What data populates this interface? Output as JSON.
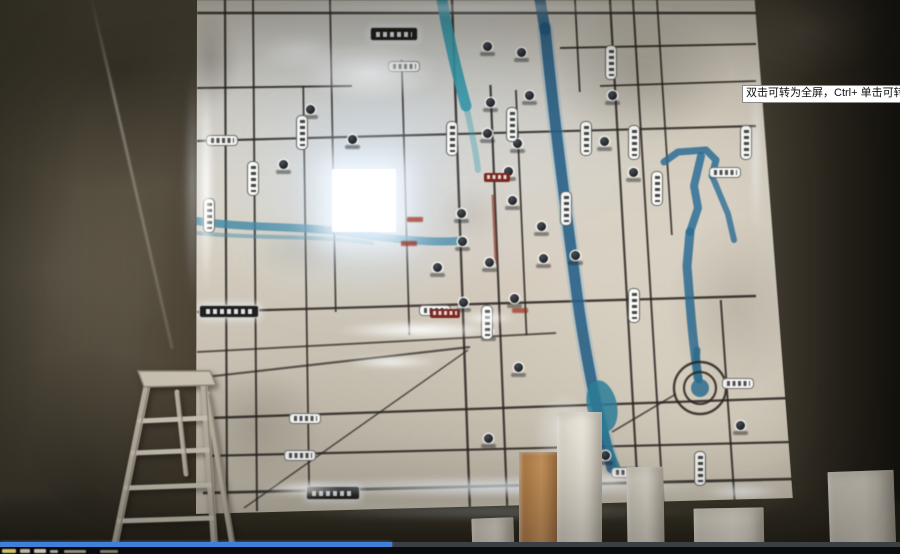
{
  "window": {
    "width": 900,
    "height": 554
  },
  "video_player": {
    "tooltip_text": "双击可转为全屏，Ctrl+ 单击可转为",
    "progress_fraction": 0.436,
    "progress_color": "#3f80d8",
    "track_color": "#3b3e44",
    "control_bar_color": "#0a0b0c",
    "control_fragments": [
      [
        2,
        549,
        14,
        4,
        "#cdbf6e"
      ],
      [
        20,
        549,
        10,
        4,
        "#b9b39e"
      ],
      [
        34,
        549,
        12,
        4,
        "#c5c0ae"
      ],
      [
        50,
        550,
        8,
        3,
        "#a8a392"
      ],
      [
        64,
        550,
        22,
        3,
        "#8f8a7a"
      ],
      [
        100,
        550,
        18,
        3,
        "#7d7868"
      ]
    ]
  },
  "palette": {
    "road": "#2b2823",
    "map_base": "#d3ccbe",
    "glow": "#eef6ff",
    "water_teal": "#3e88a8",
    "water_dark": "#255e86",
    "wall": "#4a4437",
    "ladder_metal": "#b5ad9e",
    "ladder_stroke": "#8c8679"
  },
  "map": {
    "h_roads": [
      [
        197,
        13,
        756,
        13,
        2.4
      ],
      [
        197,
        88,
        352,
        86,
        2.0
      ],
      [
        197,
        141,
        756,
        126,
        2.2
      ],
      [
        560,
        48,
        756,
        44,
        2.0
      ],
      [
        600,
        86,
        756,
        81,
        1.8
      ],
      [
        197,
        312,
        756,
        296,
        2.4
      ],
      [
        210,
        418,
        792,
        398,
        2.4
      ],
      [
        205,
        456,
        792,
        442,
        2.2
      ],
      [
        203,
        493,
        793,
        479,
        2.8
      ]
    ],
    "v_roads": [
      [
        225,
        0,
        511,
        2.2
      ],
      [
        253,
        0,
        511,
        2.0
      ],
      [
        302,
        86,
        493,
        1.8
      ],
      [
        330,
        0,
        312,
        1.8
      ],
      [
        400,
        60,
        335,
        1.8
      ],
      [
        452,
        0,
        511,
        2.4
      ],
      [
        487,
        85,
        511,
        2.2
      ],
      [
        512,
        90,
        335,
        1.8
      ],
      [
        575,
        0,
        92,
        1.8
      ],
      [
        610,
        0,
        511,
        2.2
      ],
      [
        633,
        0,
        511,
        2.0
      ],
      [
        657,
        0,
        235,
        1.8
      ],
      [
        700,
        300,
        508,
        2.0
      ],
      [
        756,
        0,
        503,
        2.6
      ]
    ],
    "diag_roads": [
      [
        197,
        352,
        556,
        333,
        2.0
      ],
      [
        197,
        378,
        470,
        347,
        2.2
      ],
      [
        244,
        508,
        468,
        350,
        1.6
      ],
      [
        612,
        432,
        676,
        394,
        1.8
      ]
    ],
    "paths": [
      {
        "d": "M545,28 C554,120 566,210 577,295 C583,340 594,398 603,432 L612,468",
        "w": 16,
        "c": "#6fa7c4",
        "o": 0.3
      },
      {
        "d": "M545,28 C554,120 566,210 577,295 C583,340 594,398 603,432 L612,468",
        "w": 11,
        "c": "#255e86",
        "o": 0.85
      },
      {
        "d": "M540,0 L545,30",
        "w": 11,
        "c": "#255e86",
        "o": 0.8
      },
      {
        "d": "M664,162 L678,152 706,150 716,160 712,176",
        "w": 7,
        "c": "#2e6f97",
        "o": 0.85
      },
      {
        "d": "M701,156 L694,186 698,208 690,232",
        "w": 8,
        "c": "#2e6f97",
        "o": 0.85
      },
      {
        "d": "M713,178 L728,214 734,240",
        "w": 6,
        "c": "#2e6f97",
        "o": 0.8
      },
      {
        "d": "M690,232 L687,266 690,304 C692,330 695,356 698,378",
        "w": 9,
        "c": "#2e6f97",
        "o": 0.85
      },
      {
        "d": "M197,221 C250,229 300,225 350,233 C395,239 427,243 458,241",
        "w": 8,
        "c": "#3e88a8",
        "o": 0.8
      },
      {
        "d": "M197,233 C255,239 315,235 372,243",
        "w": 4,
        "c": "#3e88a8",
        "o": 0.45
      },
      {
        "d": "M442,0 C448,35 456,70 466,106",
        "w": 11,
        "c": "#3aa0b2",
        "o": 0.9
      },
      {
        "d": "M466,106 C472,132 476,152 478,170",
        "w": 6,
        "c": "#3aa0b2",
        "o": 0.4
      },
      {
        "d": "M604,430 C608,448 613,460 619,472",
        "w": 7,
        "c": "#2e7f9a",
        "o": 0.8
      },
      {
        "d": "M697,350 C696,362 697,372 699,380",
        "w": 7,
        "c": "#2e6f8f",
        "o": 0.8
      },
      {
        "d": "M493,196 L496,262",
        "w": 3,
        "c": "#8a3a2e",
        "o": 0.65
      }
    ],
    "pond": {
      "cx": 602,
      "cy": 406,
      "rx": 15,
      "ry": 26,
      "rot": -12,
      "c": "#2e7f9a",
      "o": 0.85
    },
    "spiral": {
      "cx": 700,
      "cy": 388,
      "r_outer": 26,
      "r_inner": 16,
      "stroke": "#2b2721",
      "center_c": "#2e6f8f",
      "center_r": 9
    },
    "pois": [
      [
        310,
        109
      ],
      [
        283,
        164
      ],
      [
        352,
        139
      ],
      [
        490,
        102
      ],
      [
        529,
        95
      ],
      [
        487,
        133
      ],
      [
        517,
        143
      ],
      [
        508,
        171
      ],
      [
        461,
        213
      ],
      [
        512,
        200
      ],
      [
        541,
        226
      ],
      [
        462,
        241
      ],
      [
        489,
        262
      ],
      [
        543,
        258
      ],
      [
        514,
        298
      ],
      [
        463,
        302
      ],
      [
        488,
        331
      ],
      [
        604,
        141
      ],
      [
        633,
        172
      ],
      [
        612,
        95
      ],
      [
        487,
        46
      ],
      [
        521,
        52
      ],
      [
        575,
        255
      ],
      [
        605,
        455
      ],
      [
        740,
        425
      ],
      [
        488,
        438
      ],
      [
        518,
        367
      ],
      [
        437,
        267
      ]
    ],
    "v_labels": [
      [
        253,
        178
      ],
      [
        209,
        215
      ],
      [
        302,
        132
      ],
      [
        452,
        138
      ],
      [
        512,
        124
      ],
      [
        586,
        138
      ],
      [
        611,
        62
      ],
      [
        634,
        142
      ],
      [
        657,
        188
      ],
      [
        746,
        142
      ],
      [
        487,
        322
      ],
      [
        634,
        305
      ],
      [
        700,
        468
      ],
      [
        566,
        208
      ]
    ],
    "h_labels": [
      [
        222,
        140
      ],
      [
        404,
        66
      ],
      [
        305,
        418
      ],
      [
        300,
        455
      ],
      [
        435,
        310
      ],
      [
        725,
        172
      ],
      [
        738,
        383
      ],
      [
        627,
        472
      ]
    ],
    "dark_badges": [
      [
        393,
        33,
        46,
        12
      ],
      [
        228,
        310,
        58,
        11
      ],
      [
        332,
        492,
        52,
        12
      ]
    ],
    "red_badges": [
      [
        497,
        177,
        26,
        9
      ],
      [
        445,
        313,
        30,
        9
      ]
    ],
    "red_texts": [
      [
        415,
        219
      ],
      [
        409,
        243
      ],
      [
        520,
        310
      ]
    ],
    "highlight_square": {
      "x": 332,
      "y": 169,
      "w": 64,
      "h": 63
    },
    "glows": [
      [
        206,
        185,
        10,
        150,
        "#ffffff",
        0.95
      ],
      [
        370,
        72,
        95,
        42,
        "#e8f3ff",
        0.9
      ],
      [
        300,
        52,
        60,
        28,
        "#dceaf8",
        0.5
      ],
      [
        420,
        330,
        115,
        13,
        "#f2f8ff",
        0.95
      ],
      [
        392,
        362,
        65,
        10,
        "#e8f2fe",
        0.8
      ],
      [
        498,
        487,
        295,
        16,
        "#dfeefc",
        0.9
      ],
      [
        302,
        489,
        55,
        12,
        "#ffffff",
        0.9
      ],
      [
        560,
        479,
        60,
        14,
        "#ffffff",
        0.85
      ],
      [
        742,
        492,
        55,
        12,
        "#eaf4ff",
        0.8
      ],
      [
        565,
        432,
        45,
        55,
        "#cfe4f8",
        0.6
      ],
      [
        476,
        8,
        280,
        10,
        "#eef6ff",
        0.55
      ],
      [
        487,
        318,
        40,
        10,
        "#ffffff",
        0.75
      ],
      [
        756,
        150,
        9,
        120,
        "#e4f0fc",
        0.5
      ],
      [
        610,
        480,
        40,
        12,
        "#ffffff",
        0.7
      ]
    ],
    "shades": [
      [
        640,
        75,
        130,
        95,
        0.2
      ],
      [
        735,
        305,
        95,
        130,
        0.14
      ],
      [
        255,
        425,
        95,
        85,
        0.16
      ],
      [
        210,
        60,
        40,
        70,
        0.25
      ],
      [
        470,
        215,
        45,
        40,
        0.08
      ],
      [
        300,
        250,
        70,
        40,
        0.1
      ]
    ],
    "halos": [
      [
        193,
        185,
        14,
        160,
        "#dcecff",
        0.35
      ],
      [
        495,
        512,
        300,
        14,
        "#cfe2f6",
        0.3
      ]
    ]
  },
  "foreground": {
    "ladder": {
      "platform": "138,371 210,371 216,385 144,387",
      "legs": [
        [
          147,
          386,
          113,
          554,
          7
        ],
        [
          204,
          386,
          215,
          554,
          7
        ],
        [
          177,
          392,
          186,
          474,
          5
        ],
        [
          207,
          394,
          234,
          554,
          6
        ]
      ],
      "steps": [
        [
          140,
          421,
          206,
          418,
          5
        ],
        [
          133,
          453,
          208,
          450,
          5
        ],
        [
          126,
          488,
          210,
          485,
          5
        ],
        [
          119,
          521,
          213,
          518,
          5
        ]
      ]
    },
    "blocks": [
      {
        "x": 472,
        "y": 518,
        "w": 42,
        "h": 40,
        "c1": "#e3ddd0",
        "c2": "#cfc8b9",
        "rot": -2
      },
      {
        "x": 519,
        "y": 452,
        "w": 41,
        "h": 106,
        "c1": "#cf9a60",
        "c2": "#b27a42",
        "rot": 0
      },
      {
        "x": 557,
        "y": 412,
        "w": 45,
        "h": 146,
        "c1": "#ece7dc",
        "c2": "#d8d2c4",
        "rot": 0
      },
      {
        "x": 627,
        "y": 467,
        "w": 37,
        "h": 91,
        "c1": "#e2dccf",
        "c2": "#cfc9bb",
        "rot": -1
      },
      {
        "x": 694,
        "y": 508,
        "w": 70,
        "h": 50,
        "c1": "#e8e2d5",
        "c2": "#d5cfc1",
        "rot": -1
      },
      {
        "x": 829,
        "y": 471,
        "w": 66,
        "h": 87,
        "c1": "#eae4d7",
        "c2": "#d2ccbe",
        "rot": -2
      }
    ]
  }
}
